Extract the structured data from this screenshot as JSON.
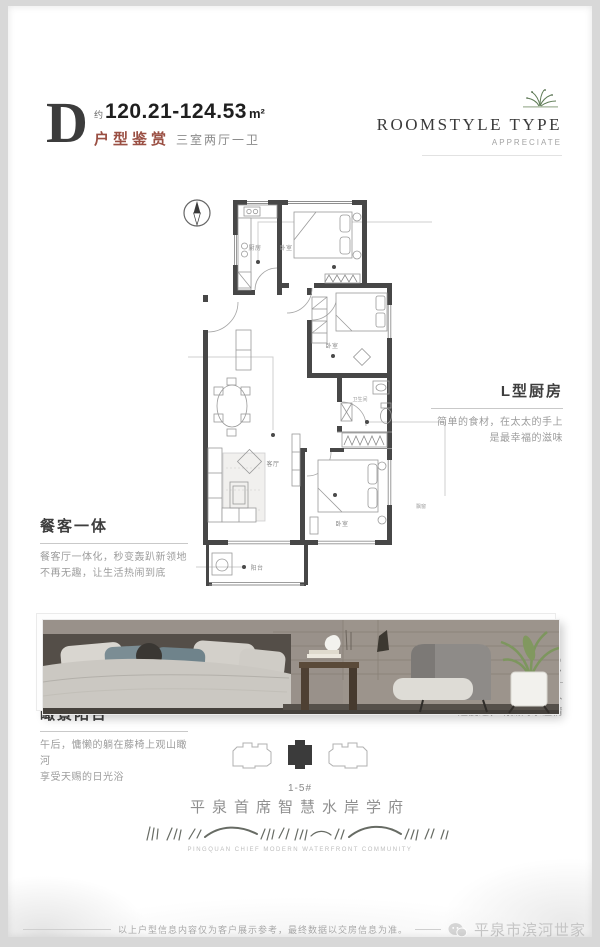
{
  "header": {
    "plan_letter": "D",
    "area_prefix": "约",
    "area_value": "120.21-124.53",
    "area_unit": "m²",
    "type_label": "户型鉴赏",
    "type_desc": "三室两厅一卫",
    "accent_color": "#9a4f43"
  },
  "brand": {
    "title": "ROOMSTYLE  TYPE",
    "subtitle": "APPRECIATE"
  },
  "callouts": [
    {
      "title": "L型厨房",
      "line1": "简单的食材，在太太的手上",
      "line2": "是最幸福的滋味"
    },
    {
      "title": "餐客一体",
      "line1": "餐客厅一体化，秒变轰趴新领地",
      "line2": "不再无趣，让生活热闹到底"
    },
    {
      "title": "全能三室",
      "line1": "最美好的时光，需要和身边的家人",
      "line2": "一起度过，纳藏阖家温情"
    },
    {
      "title": "瞰景阳台",
      "line1": "午后，慵懒的躺在藤椅上观山瞰河",
      "line2": "享受天赐的日光浴"
    }
  ],
  "plan": {
    "labels": {
      "kitchen": "厨房",
      "bedroom_top": "卧室",
      "bedroom_mid": "卧室",
      "bathroom": "卫生间",
      "living": "客厅",
      "bedroom_bottom": "卧室",
      "balcony": "阳台",
      "bay_window": "飘窗"
    },
    "wall_color": "#474747"
  },
  "building": {
    "label": "1-5#"
  },
  "project": {
    "name": "平泉首席智慧水岸学府",
    "caption_en": "PINGQUAN CHIEF MODERN WATERFRONT COMMUNITY"
  },
  "footer": {
    "disclaimer": "以上户型信息内容仅为客户展示参考，最终数据以交房信息为准。",
    "watermark": "平泉市滨河世家"
  }
}
